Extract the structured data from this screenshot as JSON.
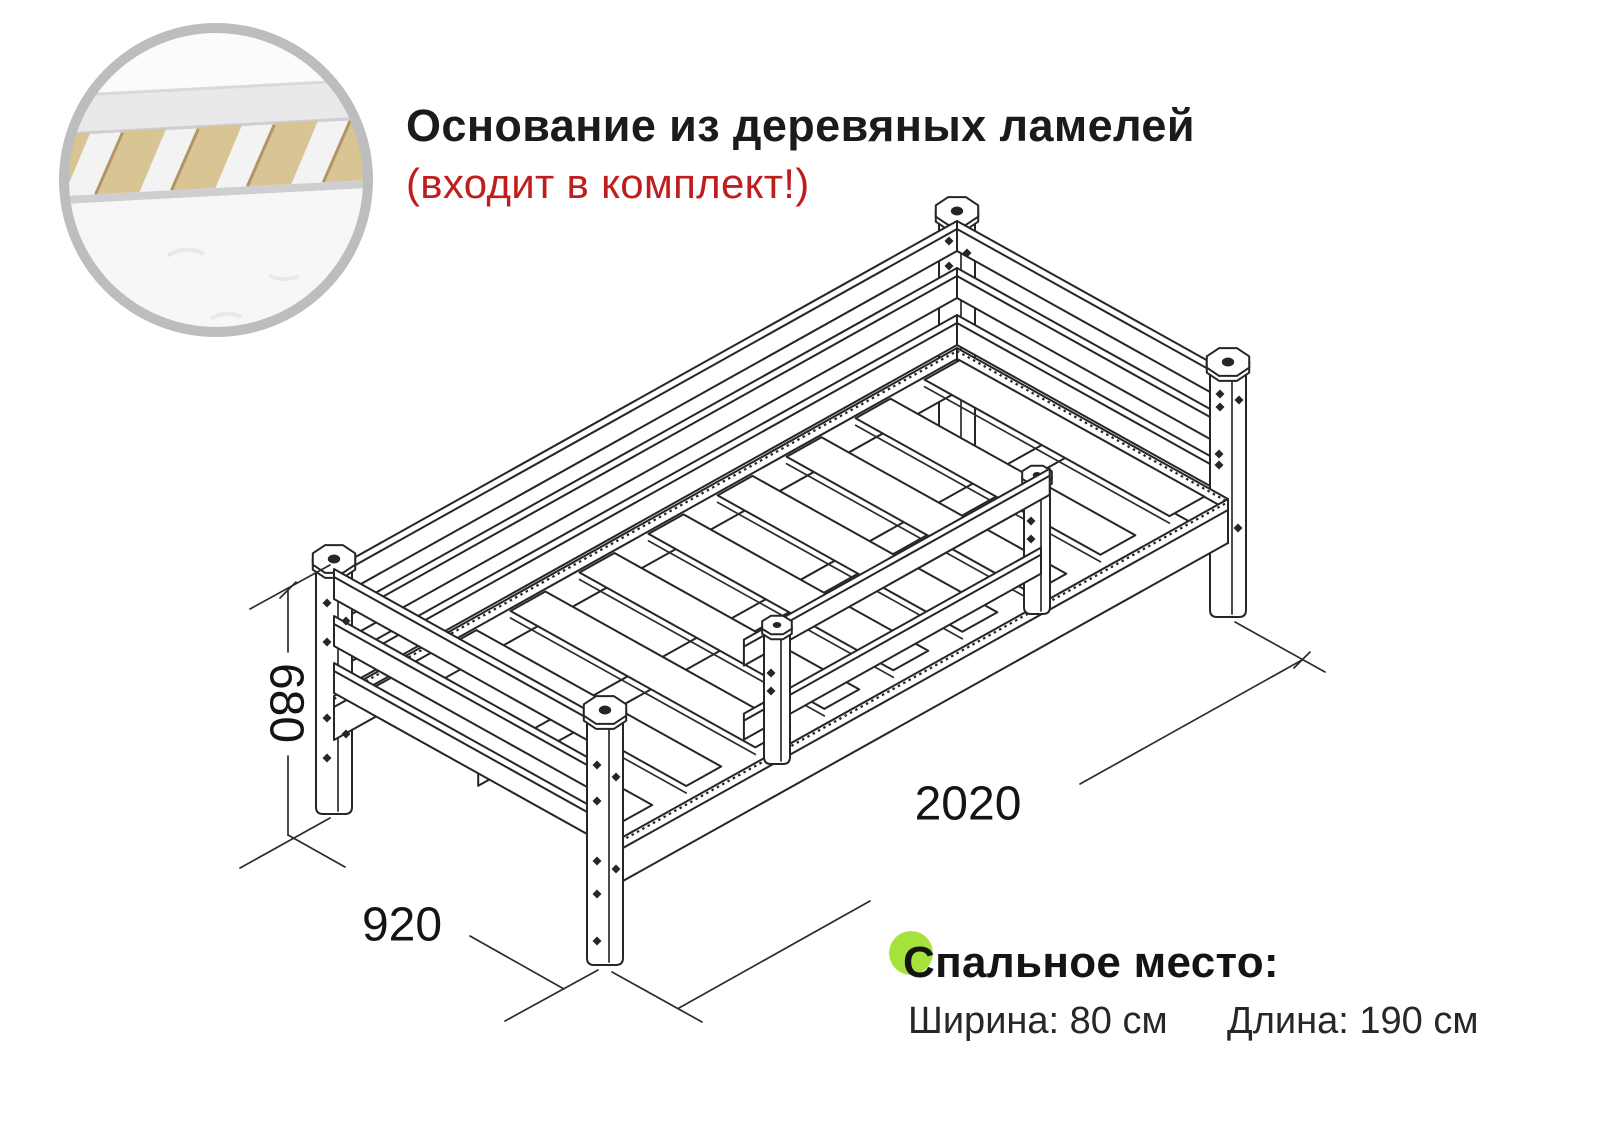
{
  "header": {
    "title": "Основание из деревяных ламелей",
    "subtitle": "(входит в комплект!)"
  },
  "dimensions": {
    "height_mm": "680",
    "width_mm": "920",
    "length_mm": "2020"
  },
  "sleeping_area": {
    "title": "Спальное место:",
    "width": "Ширина: 80 см",
    "length": "Длина: 190 см"
  },
  "inset": {
    "description": "wooden-slats-base-photo"
  },
  "colors": {
    "accent_green": "#a7e23c",
    "alert_red": "#bf1e1e",
    "line_dark": "#262626",
    "slat_wood": "#d9c493",
    "ring_gray": "#bdbdbf"
  }
}
